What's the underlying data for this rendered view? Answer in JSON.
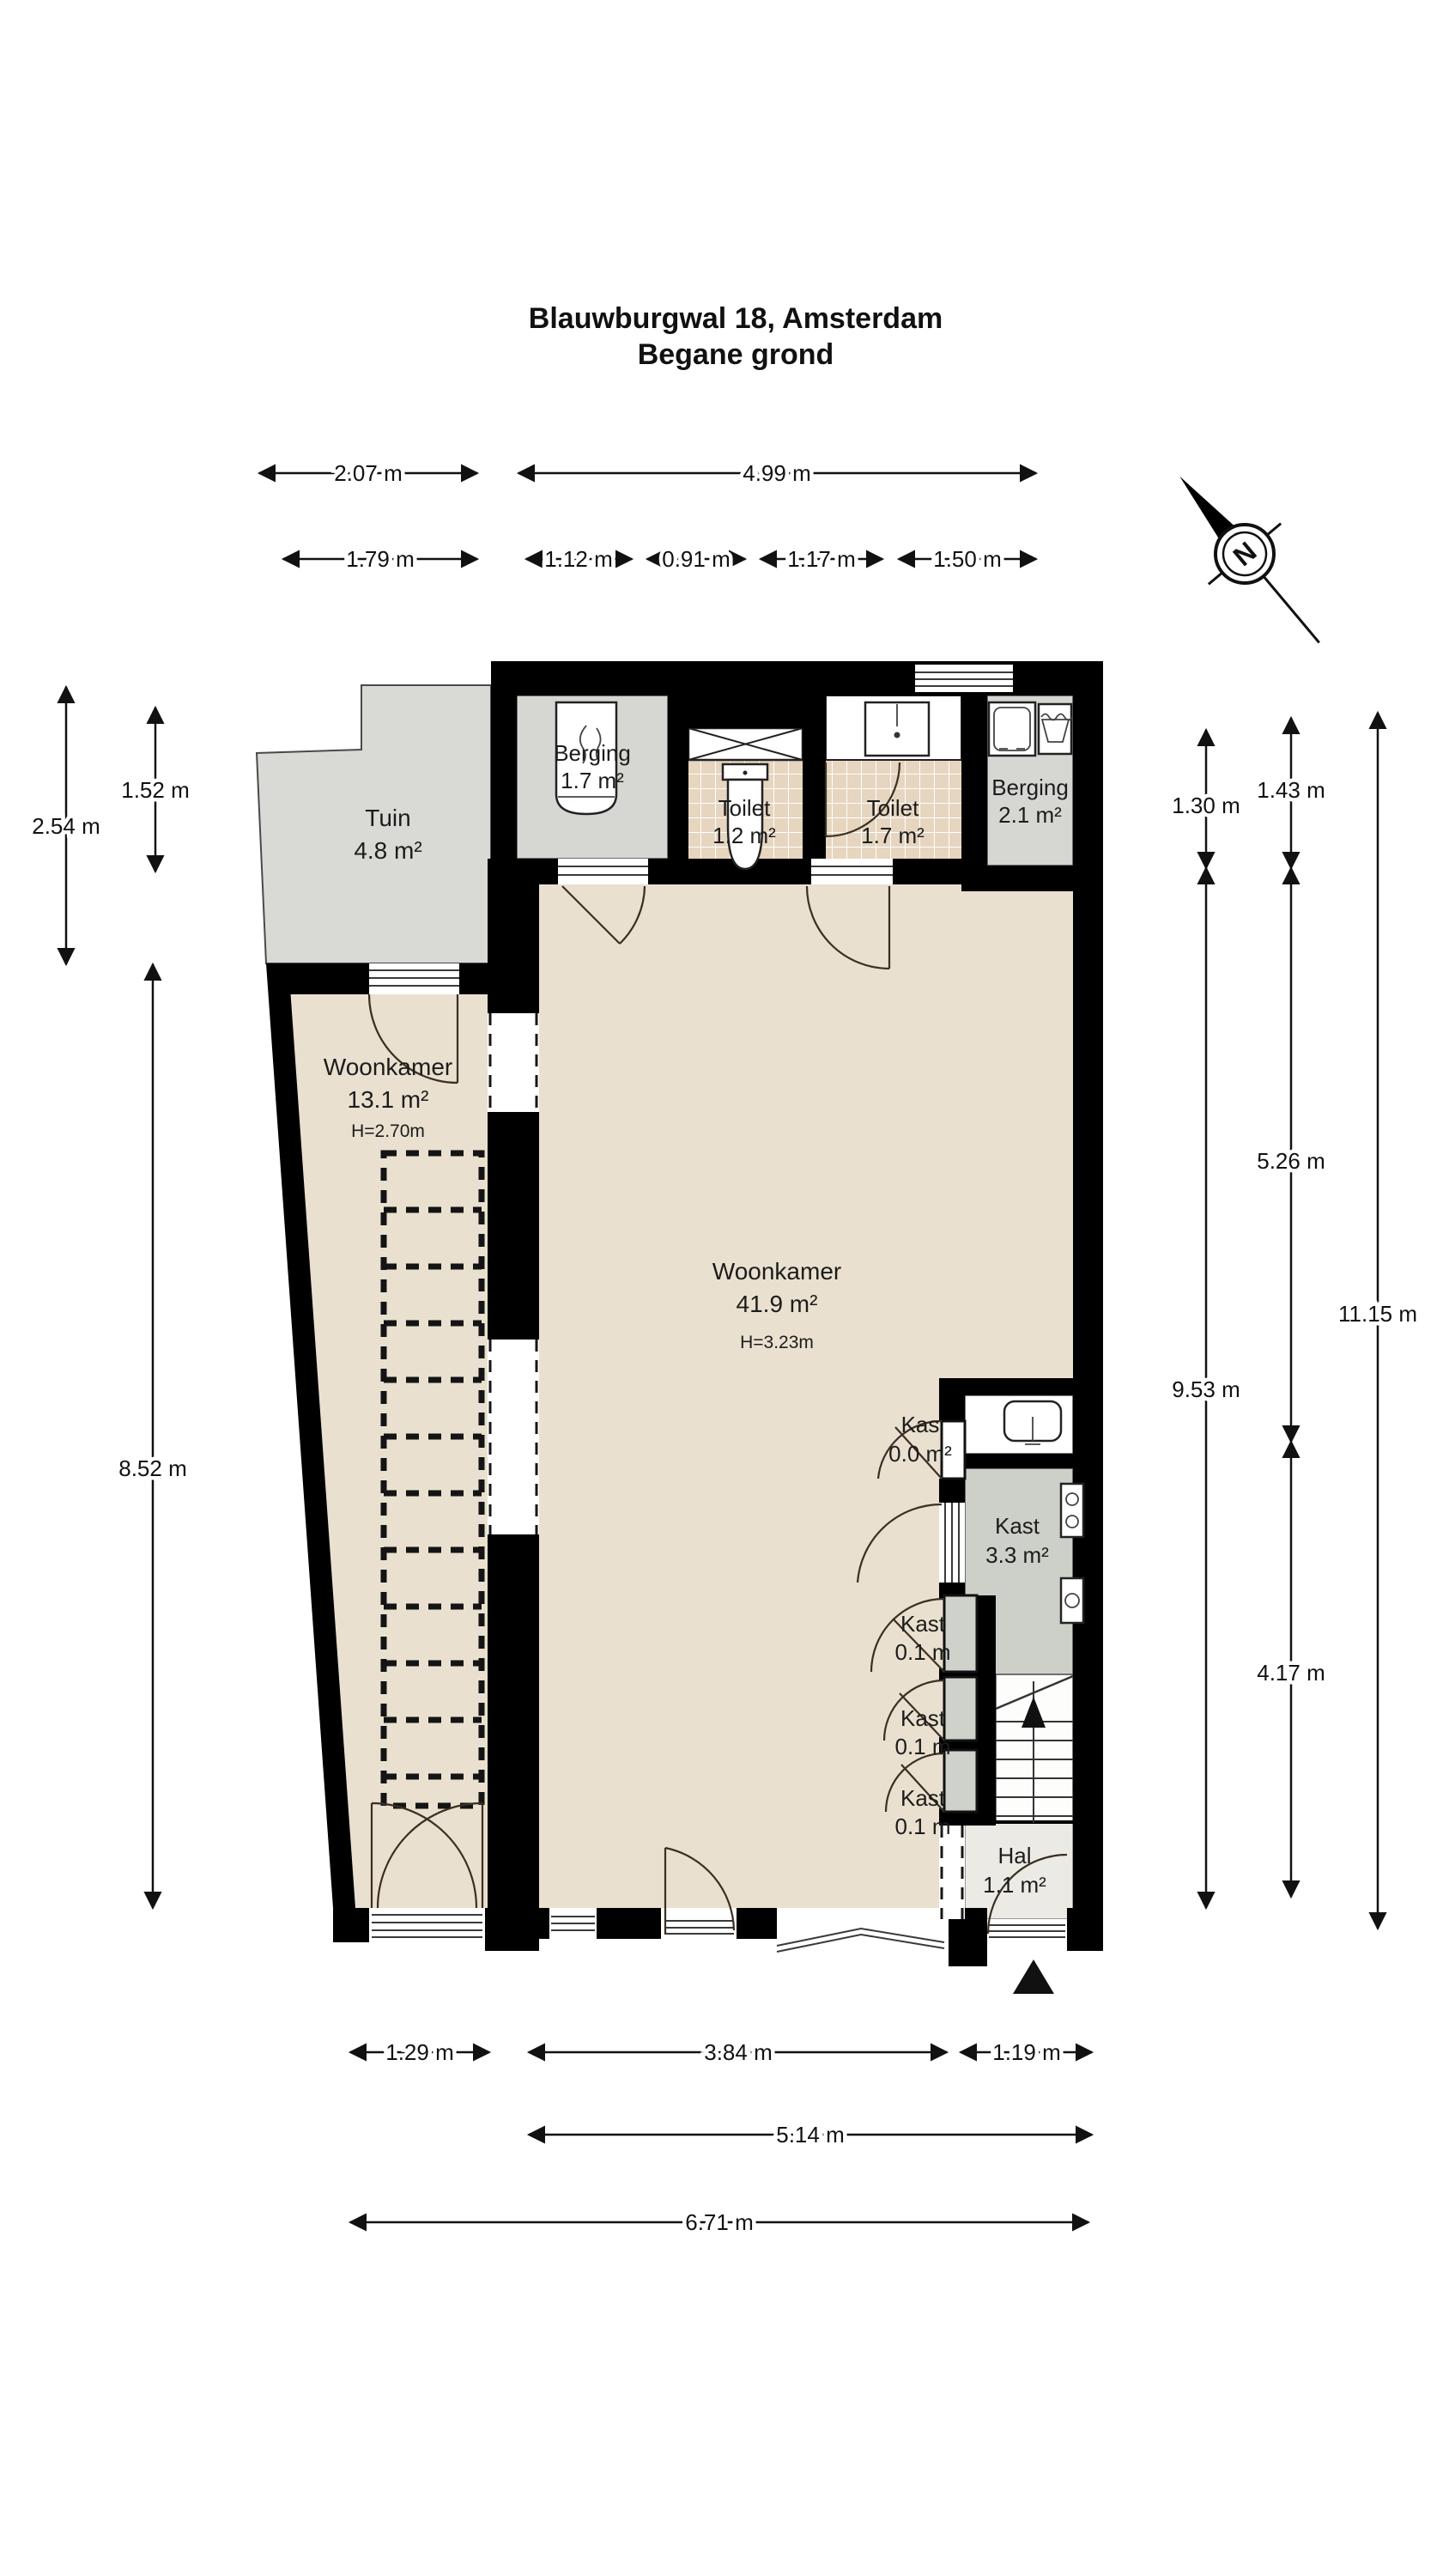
{
  "title": {
    "line1": "Blauwburgwal 18, Amsterdam",
    "line2": "Begane grond"
  },
  "compass": {
    "north_label": "N"
  },
  "rooms": {
    "tuin": {
      "name": "Tuin",
      "area": "4.8 m²"
    },
    "berging1": {
      "name": "Berging",
      "area": "1.7 m²"
    },
    "toilet1": {
      "name": "Toilet",
      "area": "1.2 m²"
    },
    "toilet2": {
      "name": "Toilet",
      "area": "1.7 m²"
    },
    "berging2": {
      "name": "Berging",
      "area": "2.1 m²"
    },
    "woonkamer1": {
      "name": "Woonkamer",
      "area": "13.1 m²",
      "height": "H=2.70m"
    },
    "woonkamer2": {
      "name": "Woonkamer",
      "area": "41.9 m²",
      "height": "H=3.23m"
    },
    "kas": {
      "name": "Kas",
      "area": "0.0 m²"
    },
    "kast33": {
      "name": "Kast",
      "area": "3.3 m²"
    },
    "kast01a": {
      "name": "Kast",
      "area": "0.1 m"
    },
    "kast01b": {
      "name": "Kast",
      "area": "0.1 m"
    },
    "kast01c": {
      "name": "Kast",
      "area": "0.1 m"
    },
    "hal": {
      "name": "Hal",
      "area": "1.1 m²"
    }
  },
  "dimensions": {
    "top_row1": [
      "2.07 m",
      "4.99 m"
    ],
    "top_row2": [
      "1.79 m",
      "1.12 m",
      "0.91 m",
      "1.17 m",
      "1.50 m"
    ],
    "left": [
      "2.54 m",
      "1.52 m",
      "8.52 m"
    ],
    "right": [
      "1.30 m",
      "1.43 m",
      "5.26 m",
      "11.15 m",
      "9.53 m",
      "4.17 m"
    ],
    "bottom_row1": [
      "1.29 m",
      "3.84 m",
      "1.19 m"
    ],
    "bottom_row2": [
      "5.14 m"
    ],
    "bottom_row3": [
      "6.71 m"
    ]
  }
}
